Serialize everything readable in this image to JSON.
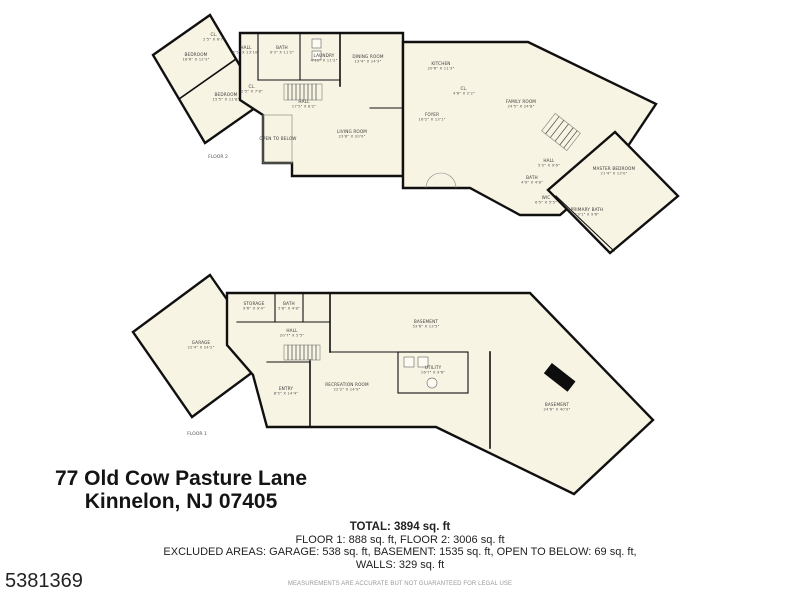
{
  "address": {
    "line1": "77 Old Cow Pasture Lane",
    "line2": "Kinnelon, NJ 07405"
  },
  "summary": {
    "total": "TOTAL: 3894 sq. ft",
    "floors": "FLOOR 1: 888 sq. ft, FLOOR 2: 3006 sq. ft",
    "excluded": "EXCLUDED AREAS: GARAGE: 538 sq. ft, BASEMENT: 1535 sq. ft, OPEN TO BELOW: 69 sq. ft,",
    "walls": "WALLS: 329 sq. ft"
  },
  "listing_id": "5381369",
  "disclaimer": "MEASUREMENTS ARE ACCURATE BUT NOT GUARANTEED FOR LEGAL USE",
  "colors": {
    "floor_fill": "#f8f4e3",
    "wall": "#101010",
    "background": "#ffffff",
    "label_text": "#3a3a3a"
  },
  "floor2": {
    "caption": {
      "text": "FLOOR 2",
      "x": 218,
      "y": 158
    },
    "rooms": [
      {
        "name": "BEDROOM",
        "dims": "16'6\" X 12'3\"",
        "x": 196,
        "y": 56
      },
      {
        "name": "BEDROOM",
        "dims": "15'5\" X 11'8\"",
        "x": 226,
        "y": 96
      },
      {
        "name": "CL.",
        "dims": "2'5\" X 6'7\"",
        "x": 214,
        "y": 36
      },
      {
        "name": "CL.",
        "dims": "2'5\" X 7'8\"",
        "x": 252,
        "y": 88
      },
      {
        "name": "HALL",
        "dims": "5'5\" X 13'10\"",
        "x": 246,
        "y": 49
      },
      {
        "name": "BATH",
        "dims": "9'3\" X 11'2\"",
        "x": 282,
        "y": 49
      },
      {
        "name": "LAUNDRY",
        "dims": "4'11\" X 11'2\"",
        "x": 324,
        "y": 57
      },
      {
        "name": "DINING ROOM",
        "dims": "13'4\" X 14'3\"",
        "x": 368,
        "y": 58
      },
      {
        "name": "KITCHEN",
        "dims": "20'6\" X 11'3\"",
        "x": 441,
        "y": 65
      },
      {
        "name": "CL.",
        "dims": "4'6\" X 2'2\"",
        "x": 464,
        "y": 90
      },
      {
        "name": "FAMILY ROOM",
        "dims": "24'5\" X 24'8\"",
        "x": 521,
        "y": 103
      },
      {
        "name": "FOYER",
        "dims": "16'2\" X 13'1\"",
        "x": 432,
        "y": 116
      },
      {
        "name": "HALL",
        "dims": "17'5\" X 8'2\"",
        "x": 304,
        "y": 103
      },
      {
        "name": "LIVING ROOM",
        "dims": "23'8\" X 20'0\"",
        "x": 352,
        "y": 133
      },
      {
        "name": "OPEN TO BELOW",
        "dims": "",
        "x": 278,
        "y": 140
      },
      {
        "name": "HALL",
        "dims": "5'2\" X 9'6\"",
        "x": 549,
        "y": 162
      },
      {
        "name": "BATH",
        "dims": "4'9\" X 4'8\"",
        "x": 532,
        "y": 179
      },
      {
        "name": "WIC",
        "dims": "6'5\" X 5'5\"",
        "x": 546,
        "y": 199
      },
      {
        "name": "PRIMARY BATH",
        "dims": "13'1\" X 9'6\"",
        "x": 587,
        "y": 211
      },
      {
        "name": "MASTER BEDROOM",
        "dims": "21'4\" X 13'0\"",
        "x": 614,
        "y": 170
      }
    ]
  },
  "floor1": {
    "caption": {
      "text": "FLOOR 1",
      "x": 197,
      "y": 435
    },
    "rooms": [
      {
        "name": "GARAGE",
        "dims": "22'4\" X 24'2\"",
        "x": 201,
        "y": 344
      },
      {
        "name": "STORAGE",
        "dims": "9'6\" X 9'4\"",
        "x": 254,
        "y": 305
      },
      {
        "name": "BATH",
        "dims": "5'8\" X 4'8\"",
        "x": 289,
        "y": 305
      },
      {
        "name": "HALL",
        "dims": "20'7\" X 5'5\"",
        "x": 292,
        "y": 332
      },
      {
        "name": "ENTRY",
        "dims": "8'5\" X 14'4\"",
        "x": 286,
        "y": 390
      },
      {
        "name": "RECREATION ROOM",
        "dims": "22'2\" X 14'9\"",
        "x": 347,
        "y": 386
      },
      {
        "name": "UTILITY",
        "dims": "16'7\" X 9'6\"",
        "x": 433,
        "y": 369
      },
      {
        "name": "BASEMENT",
        "dims": "53'6\" X 13'5\"",
        "x": 426,
        "y": 323
      },
      {
        "name": "BASEMENT",
        "dims": "24'6\" X 40'9\"",
        "x": 557,
        "y": 406
      }
    ]
  }
}
